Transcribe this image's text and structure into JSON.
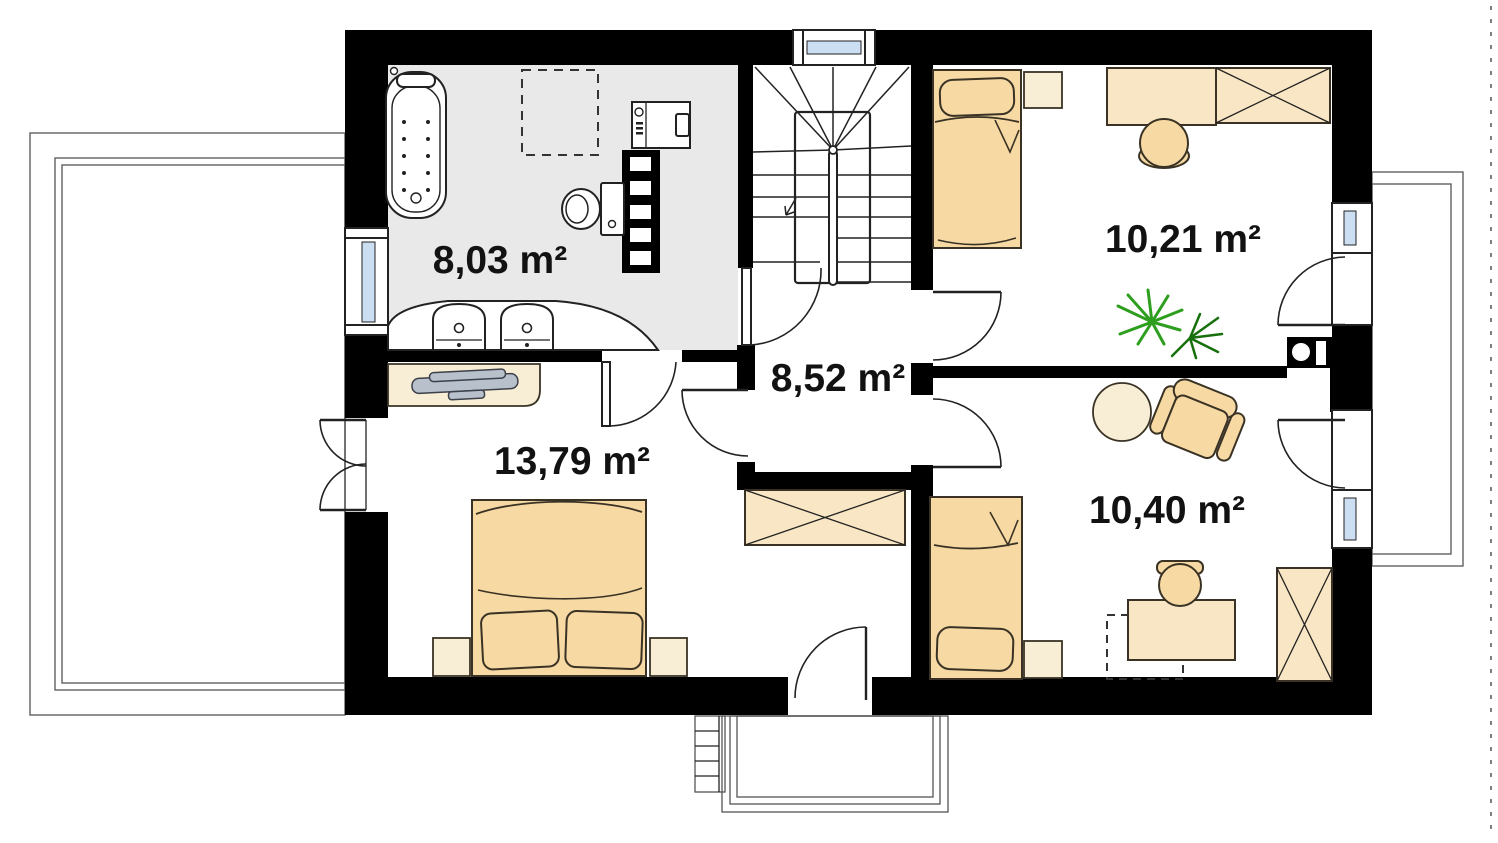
{
  "plan_name": "first-floor-plan",
  "rooms": [
    {
      "id": "bathroom",
      "area_label": "8,03 m²",
      "floor": "gray-tile",
      "furniture": [
        "bathtub",
        "washing-machine",
        "towel-radiator",
        "toilet",
        "double-washbasin-vanity",
        "skylight-dashed-outline"
      ]
    },
    {
      "id": "bedroom-top-right",
      "area_label": "10,21 m²",
      "furniture": [
        "single-bed",
        "nightstand",
        "desk",
        "wardrobe",
        "stool",
        "plant",
        "balcony-door"
      ]
    },
    {
      "id": "hall",
      "area_label": "8,52 m²",
      "furniture": [
        "staircase",
        "built-in-wardrobe"
      ]
    },
    {
      "id": "bedroom-left",
      "area_label": "13,79 m²",
      "furniture": [
        "double-bed",
        "nightstand-left",
        "nightstand-right",
        "dresser",
        "tv-on-dresser",
        "terrace-french-door"
      ]
    },
    {
      "id": "bedroom-bottom-right",
      "area_label": "10,40 m²",
      "furniture": [
        "single-bed",
        "nightstand",
        "round-table",
        "armchair",
        "desk",
        "desk-chair",
        "wardrobe",
        "balcony-door"
      ]
    }
  ],
  "exterior": [
    "left-terrace",
    "bottom-terrace",
    "exterior-steps",
    "right-balcony",
    "roof-edge-dashed-line",
    "chimney"
  ],
  "colors": {
    "wall": "#000000",
    "line": "#222222",
    "outline": "#3a3325",
    "bathroom-floor": "#e9e9e9",
    "furniture": "#f7d9a4",
    "furniture-light": "#f8eed6",
    "wardrobe": "#f9e6c4",
    "glazing": "#ccdff2",
    "plant": "#2e9e1e",
    "plant-dark": "#17700c",
    "metal": "#b7c0cb",
    "label": "#121212"
  }
}
